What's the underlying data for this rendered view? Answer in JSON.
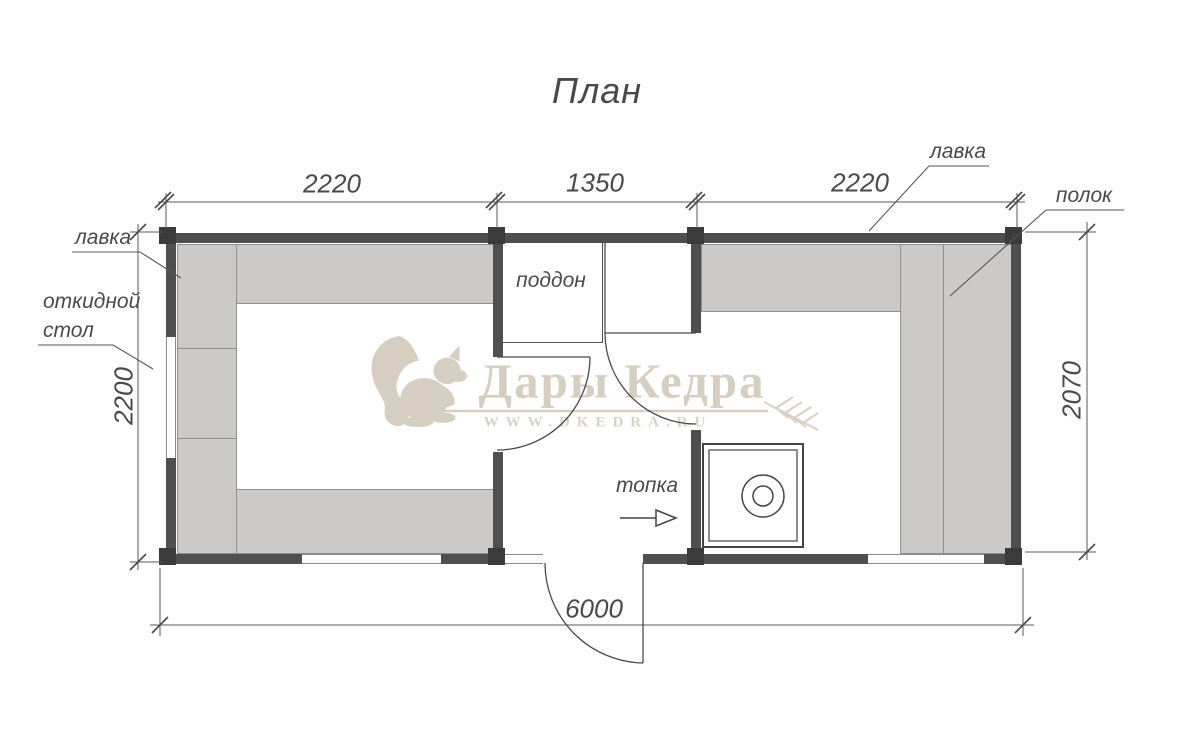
{
  "title": {
    "text": "План"
  },
  "dimensions": {
    "top_segment_left": "2220",
    "top_segment_middle": "1350",
    "top_segment_right": "2220",
    "left_side": "2200",
    "right_side": "2070",
    "bottom_total": "6000"
  },
  "labels": {
    "bench_left": "лавка",
    "folding_table_line1": "откидной",
    "folding_table_line2": "стол",
    "shower_tray": "поддон",
    "firebox": "топка",
    "bench_right": "лавка",
    "shelf": "полок"
  },
  "watermark": {
    "brand": "Дары Кедра",
    "website": "WWW.DKEDRA.RU"
  },
  "colors": {
    "wall": "#4f4f4f",
    "corner_post": "#3b3b3b",
    "bench_fill": "#cbcac8",
    "bench_border": "#8f8f8f",
    "line": "#555555",
    "watermark": "#d7cfc2"
  }
}
